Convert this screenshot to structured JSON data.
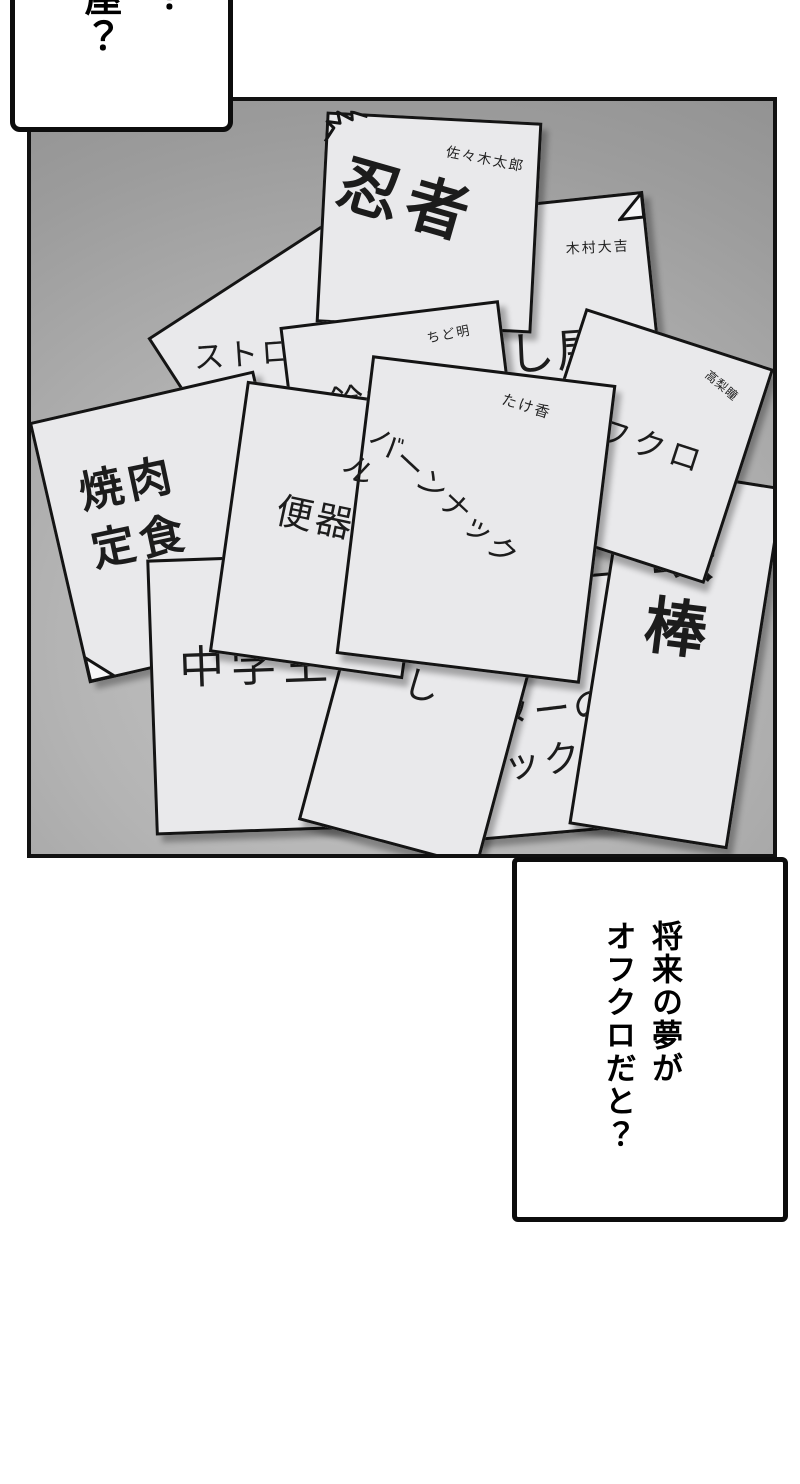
{
  "scene": {
    "type": "manga-panel-page",
    "description": "pile of dream-survey papers"
  },
  "bubble_top": {
    "col_main": "屋？",
    "col_right": "？"
  },
  "bubble_bottom": {
    "text": "将来の夢が\nオフクロだと？"
  },
  "papers": [
    {
      "id": "straw",
      "label": "ストロー"
    },
    {
      "id": "hitman",
      "label": "殺し屋",
      "owner": "木村大吉"
    },
    {
      "id": "ninja",
      "label": "忍者",
      "owner": "佐々木太郎"
    },
    {
      "id": "yakiniku",
      "label": "焼肉\n定食"
    },
    {
      "id": "suzuki",
      "label": "鈴木",
      "owner": "ちど明",
      "doodle_icon": "❀"
    },
    {
      "id": "chugakusei",
      "label": "中学生"
    },
    {
      "id": "pick",
      "label": "ターの\nピック"
    },
    {
      "id": "moyashi",
      "label": "もやし"
    },
    {
      "id": "tetsubo",
      "label": "鉄棒"
    },
    {
      "id": "ofukuro",
      "label": "オフクロ",
      "owner": "高梨瞳"
    },
    {
      "id": "benki",
      "label": "便器"
    },
    {
      "id": "burn",
      "label": "バーンナックル",
      "owner": "たけ香"
    }
  ],
  "colors": {
    "page_bg": "#ffffff",
    "panel_gradient_light": "#c7c7c7",
    "panel_gradient_dark": "#8c8c8c",
    "paper": "#e9e9eb",
    "ink": "#111111"
  }
}
